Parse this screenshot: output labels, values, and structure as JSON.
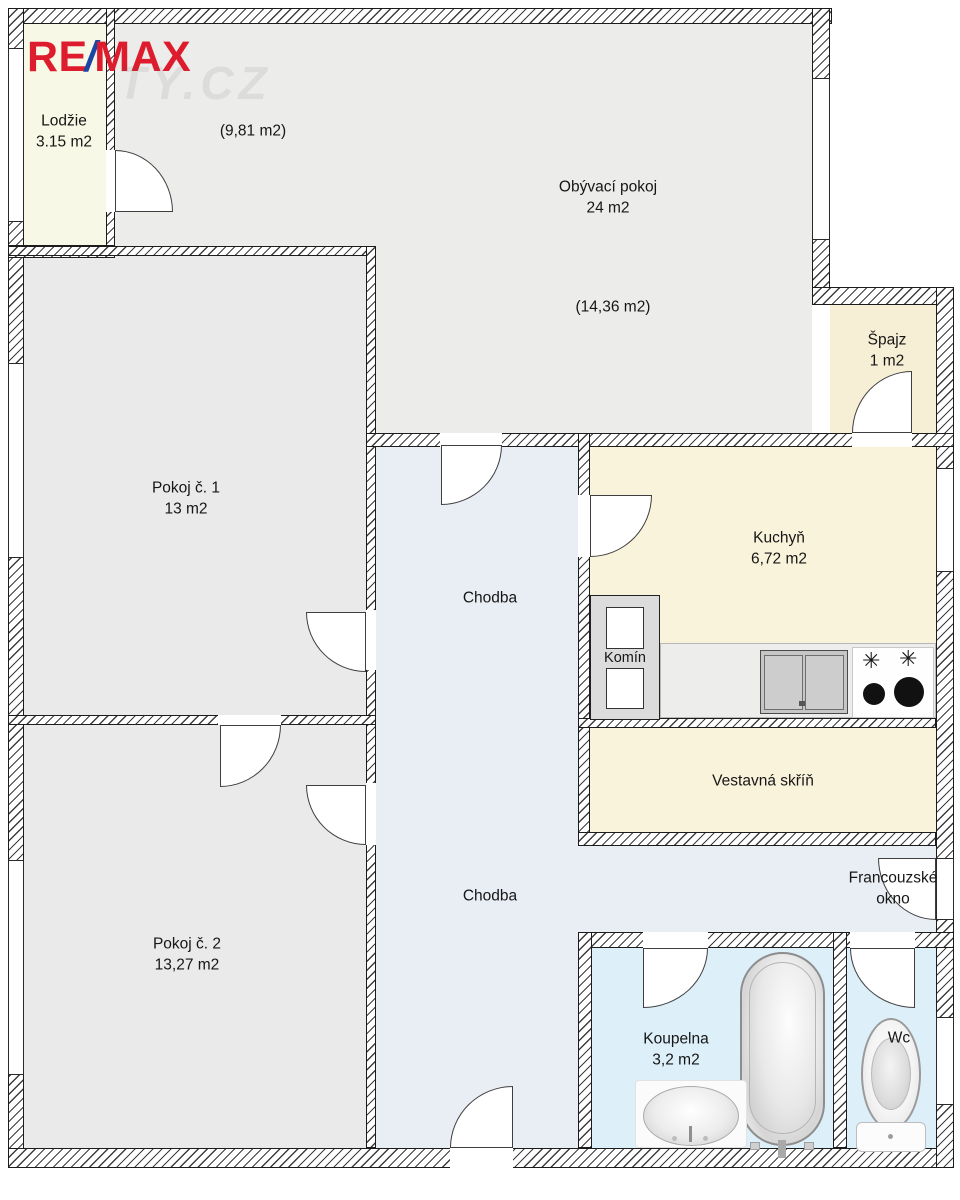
{
  "logo": {
    "re": "RE",
    "slash": "/",
    "max": "MAX"
  },
  "watermark": "TY.CZ",
  "rooms": {
    "lodzie": {
      "name": "Lodžie",
      "area": "3.15 m2"
    },
    "obyvaci_pokoj": {
      "name": "Obývací pokoj",
      "area": "24 m2",
      "part1": "(9,81 m2)",
      "part2": "(14,36 m2)"
    },
    "spajz": {
      "name": "Špajz",
      "area": "1 m2"
    },
    "pokoj_1": {
      "name": "Pokoj č. 1",
      "area": "13 m2"
    },
    "pokoj_2": {
      "name": "Pokoj č. 2",
      "area": "13,27 m2"
    },
    "chodba_upper": {
      "name": "Chodba"
    },
    "chodba_lower": {
      "name": "Chodba"
    },
    "kuchyn": {
      "name": "Kuchyň",
      "area": "6,72 m2"
    },
    "komin": {
      "name": "Komín"
    },
    "vestavna_skrin": {
      "name": "Vestavná skříň"
    },
    "francouzske_okno": {
      "name": "Francouzské okno"
    },
    "koupelna": {
      "name": "Koupelna",
      "area": "3,2 m2"
    },
    "wc": {
      "name": "Wc"
    }
  },
  "icons": {
    "stove_burner_glyph": "✳"
  },
  "colors": {
    "logo_red": "#dd1d2d",
    "logo_blue": "#1b46a5",
    "room_gray": "#ebebea",
    "hall_blue": "#e9edf4",
    "kitchen_cream": "#faf3dc",
    "pantry_cream": "#f6efd6",
    "closet_cream": "#f8f3da",
    "balcony_cream": "#f8f8e6",
    "bath_blue": "#ddeff8",
    "wall_line": "#1c1c1c"
  }
}
